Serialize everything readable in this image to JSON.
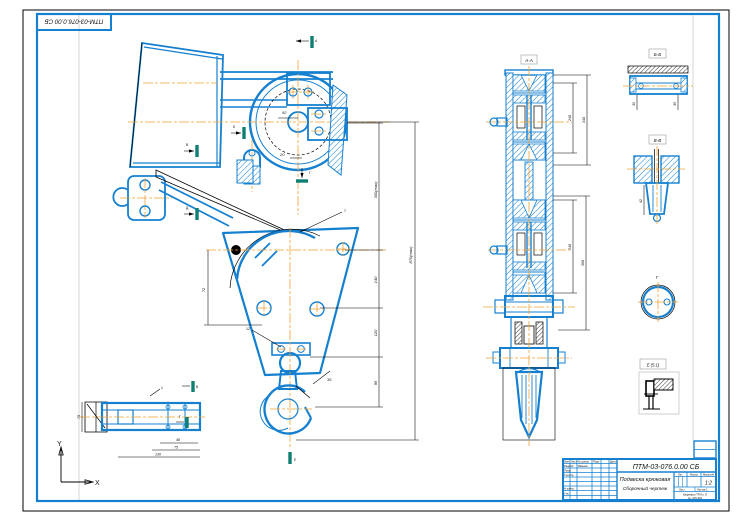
{
  "stamp": {
    "designation": "ПТМ-03-076.0.00 СБ"
  },
  "title_block": {
    "designation": "ПТМ-03-076.0.00 СБ",
    "doc_name_line1": "Подвеска крюковая",
    "doc_name_line2": "Сборочный чертеж",
    "col_izm": "Изм.",
    "col_list": "Лист",
    "col_ndoc": "№ докум.",
    "col_podp": "Подп.",
    "col_data": "Дата",
    "row_razrab": "Разраб.",
    "row_prov": "Пров.",
    "row_tkontr": "Т.контр.",
    "row_nkontr": "Н.контр.",
    "row_utv": "Утв.",
    "name_razrab": "Иванов",
    "lit_label": "Лит.",
    "massa_label": "Масса",
    "masshtab_label": "Масштаб",
    "scale_value": "1:2",
    "list_label": "Лист",
    "listov_label": "Листов 1",
    "org_line1": "Кафедра ПТМ и О",
    "org_line2": "гр. МЗ-401"
  },
  "section_labels": {
    "sec_a": "А-А",
    "sec_b": "Б-Б",
    "sec_v": "В-В",
    "view_g": "Г",
    "detail_e": "Е (5:1)"
  },
  "cut_letters": {
    "m1": "А",
    "m2": "Б",
    "m3": "В",
    "m4": "Г",
    "m5": "Д",
    "m6": "Е",
    "ax1": "В",
    "ax2": "Г"
  },
  "dims": {
    "d_right_1": "300(max)",
    "d_right_2": "140",
    "d_right_3": "120",
    "d_right_4": "95",
    "d_outer": "870(max)",
    "d_left": "72",
    "d_top": "92",
    "d_misc": "20",
    "d_hook": "36",
    "axle_d1": "48",
    "axle_d2": "75",
    "axle_d3": "130",
    "axle_d4": "70",
    "sec_d1": "240",
    "sec_d2": "360",
    "sec_d3": "240",
    "sec_d4": "340",
    "bb_d1": "30",
    "bb_d2": "35",
    "vv_d1": "42"
  },
  "positions": {
    "p1": "7",
    "p2": "12",
    "p3": "1"
  },
  "axes": {
    "x": "X",
    "y": "Y"
  },
  "colors": {
    "line_blue": "#1580d0",
    "centerline_orange": "#f0a235",
    "section_teal": "#0e7f72",
    "dim_black": "#000000"
  }
}
